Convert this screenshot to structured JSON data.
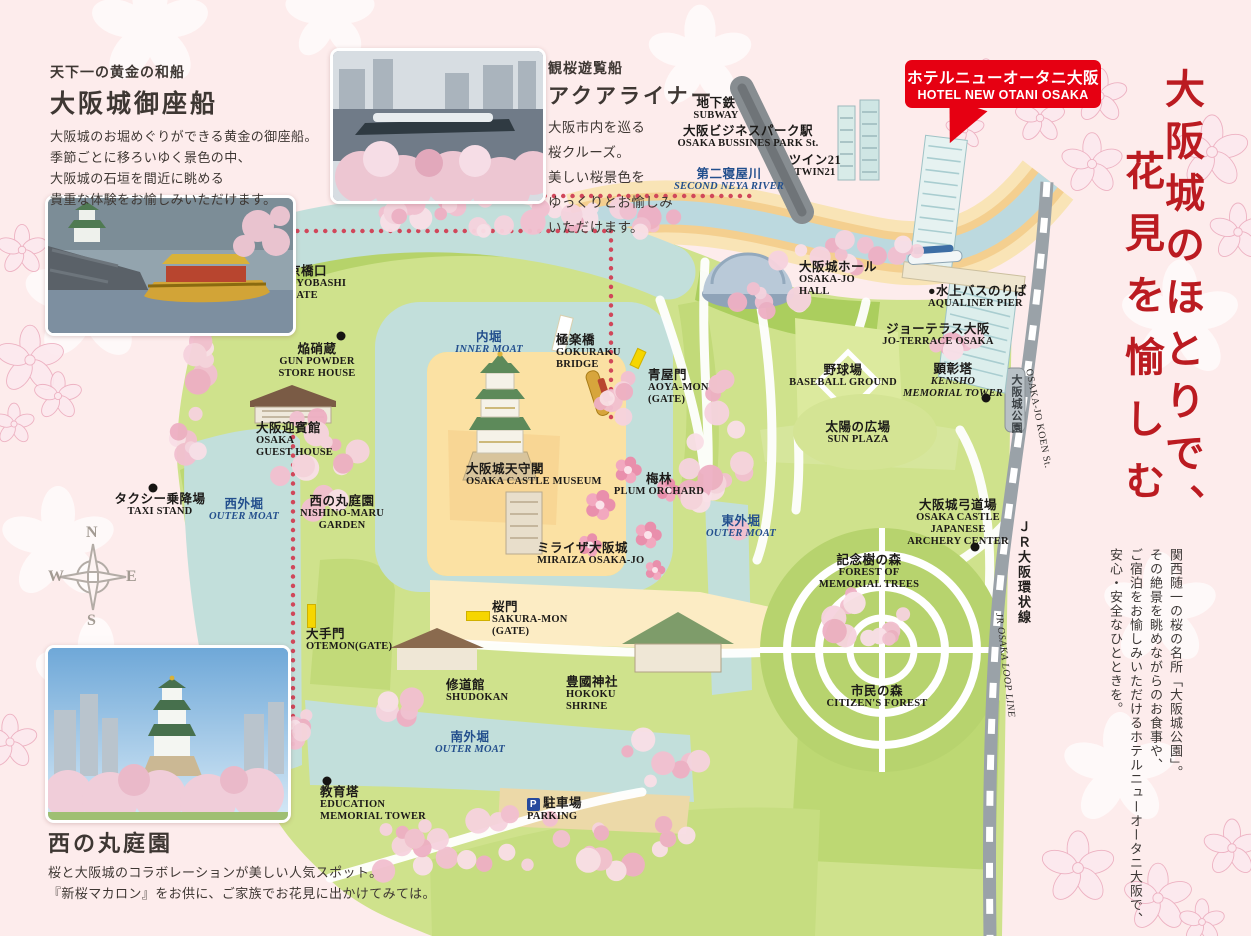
{
  "headline": {
    "line1": "大阪城のほとりで、",
    "line2": "花見を愉しむ"
  },
  "tagline": {
    "col1": "関西随一の桜の名所「大阪城公園」。",
    "col2": "その絶景を眺めながらのお食事や、",
    "col3": "ご宿泊をお愉しみいただけるホテルニューオータニ大阪で、",
    "col4": "安心・安全なひとときを。"
  },
  "hotel_badge": {
    "jp": "ホテルニューオータニ大阪",
    "en": "HOTEL NEW OTANI OSAKA",
    "bg": "#e60012"
  },
  "gozabune_info": {
    "subtitle": "天下一の黄金の和船",
    "title": "大阪城御座船",
    "body": "大阪城のお堀めぐりができる黄金の御座船。\n季節ごとに移ろいゆく景色の中、\n大阪城の石垣を間近に眺める\n貴重な体験をお愉しみいただけます。"
  },
  "aqualiner_info": {
    "subtitle": "観桜遊覧船",
    "title": "アクアライナー",
    "body": "大阪市内を巡る\n桜クルーズ。\n美しい桜景色を\nゆっくりとお愉しみ\nいただけます。"
  },
  "nishinomaru_info": {
    "title": "西の丸庭園",
    "body": "桜と大阪城のコラボレーションが美しい人気スポット。\n『新桜マカロン』をお供に、ご家族でお花見に出かけてみては。"
  },
  "compass": {
    "n": "N",
    "e": "E",
    "s": "S",
    "w": "W"
  },
  "railway": {
    "station_jp": "大阪城公園",
    "station_en": "OSAKA-JO KOEN St.",
    "line_jp": "ＪＲ大阪環状線",
    "line_en": "JR OSAKA LOOP LINE"
  },
  "icons": {
    "parking": "P"
  },
  "colors": {
    "accent_red": "#bb1b21",
    "badge_red": "#e60012",
    "moat_blue": "#c2dfdb",
    "park_green": "#cfe28c",
    "label_blue": "#234f8d",
    "dotted_red": "#d0475a"
  },
  "map_labels": [
    {
      "id": "subway",
      "jp": "地下鉄",
      "en": "SUBWAY",
      "x": 716,
      "y": 96,
      "align": "c"
    },
    {
      "id": "obp-station",
      "jp": "大阪ビジネスパーク駅",
      "en": "OSAKA BUSSINES PARK St.",
      "x": 748,
      "y": 124,
      "align": "c"
    },
    {
      "id": "twin21",
      "jp": "ツイン21",
      "en": "TWIN21",
      "x": 815,
      "y": 153,
      "align": "c"
    },
    {
      "id": "second-neya-river",
      "jp": "第二寝屋川",
      "en": "SECOND NEYA RIVER",
      "x": 729,
      "y": 167,
      "align": "c",
      "color": "b",
      "it": true
    },
    {
      "id": "osakajo-hall",
      "jp": "大阪城ホール",
      "en": "OSAKA-JO\nHALL",
      "x": 799,
      "y": 260,
      "align": "l"
    },
    {
      "id": "aqualiner-pier",
      "jp": "●水上バスのりば",
      "en": "AQUALINER PIER",
      "x": 928,
      "y": 284,
      "align": "l"
    },
    {
      "id": "jo-terrace",
      "jp": "ジョーテラス大阪",
      "en": "JO-TERRACE OSAKA",
      "x": 938,
      "y": 322,
      "align": "c"
    },
    {
      "id": "baseball-ground",
      "jp": "野球場",
      "en": "BASEBALL GROUND",
      "x": 843,
      "y": 363,
      "align": "c"
    },
    {
      "id": "kensho-tower",
      "jp": "顕彰塔",
      "en": "KENSHO\nMEMORIAL TOWER",
      "x": 953,
      "y": 362,
      "align": "c",
      "it": true
    },
    {
      "id": "sun-plaza",
      "jp": "太陽の広場",
      "en": "SUN PLAZA",
      "x": 858,
      "y": 420,
      "align": "c"
    },
    {
      "id": "archery-center",
      "jp": "大阪城弓道場",
      "en": "OSAKA CASTLE\nJAPANESE\nARCHERY CENTER",
      "x": 958,
      "y": 498,
      "align": "c"
    },
    {
      "id": "inner-moat",
      "jp": "内堀",
      "en": "INNER MOAT",
      "x": 489,
      "y": 330,
      "align": "c",
      "color": "b",
      "it": true
    },
    {
      "id": "gokuraku-bridge",
      "jp": "極楽橋",
      "en": "GOKURAKU\nBRIDGE",
      "x": 556,
      "y": 333,
      "align": "l"
    },
    {
      "id": "aoya-mon",
      "jp": "青屋門",
      "en": "AOYA-MON\n(GATE)",
      "x": 648,
      "y": 368,
      "align": "l"
    },
    {
      "id": "gunpowder-storehouse",
      "jp": "焔硝蔵",
      "en": "GUN POWDER\nSTORE HOUSE",
      "x": 317,
      "y": 342,
      "align": "c"
    },
    {
      "id": "guest-house",
      "jp": "大阪迎賓館",
      "en": "OSAKA\nGUEST HOUSE",
      "x": 256,
      "y": 421,
      "align": "l"
    },
    {
      "id": "kyobashi-gate",
      "jp": "京橋口",
      "en": "KYOBASHI\nGATE",
      "x": 288,
      "y": 264,
      "align": "l"
    },
    {
      "id": "taxi-stand",
      "jp": "タクシー乗降場",
      "en": "TAXI STAND",
      "x": 160,
      "y": 492,
      "align": "c"
    },
    {
      "id": "outer-moat-west",
      "jp": "西外堀",
      "en": "OUTER MOAT",
      "x": 244,
      "y": 497,
      "align": "c",
      "color": "b",
      "it": true
    },
    {
      "id": "nishino-maru-garden",
      "jp": "西の丸庭園",
      "en": "NISHINO-MARU\nGARDEN",
      "x": 342,
      "y": 494,
      "align": "c"
    },
    {
      "id": "castle-museum",
      "jp": "大阪城天守閣",
      "en": "OSAKA CASTLE MUSEUM",
      "x": 466,
      "y": 462,
      "align": "l"
    },
    {
      "id": "plum-orchard",
      "jp": "梅林",
      "en": "PLUM ORCHARD",
      "x": 659,
      "y": 472,
      "align": "c"
    },
    {
      "id": "miraiza",
      "jp": "ミライザ大阪城",
      "en": "MIRAIZA OSAKA-JO",
      "x": 537,
      "y": 541,
      "align": "l"
    },
    {
      "id": "outer-moat-east",
      "jp": "東外堀",
      "en": "OUTER MOAT",
      "x": 741,
      "y": 514,
      "align": "c",
      "color": "b",
      "it": true
    },
    {
      "id": "memorial-trees",
      "jp": "記念樹の森",
      "en": "FOREST OF\nMEMORIAL TREES",
      "x": 869,
      "y": 553,
      "align": "c"
    },
    {
      "id": "citizens-forest",
      "jp": "市民の森",
      "en": "CITIZEN'S FOREST",
      "x": 877,
      "y": 684,
      "align": "c"
    },
    {
      "id": "otemon-gate",
      "jp": "大手門",
      "en": "OTEMON(GATE)",
      "x": 306,
      "y": 627,
      "align": "l"
    },
    {
      "id": "sakura-mon",
      "jp": "桜門",
      "en": "SAKURA-MON\n(GATE)",
      "x": 492,
      "y": 600,
      "align": "l"
    },
    {
      "id": "shudokan",
      "jp": "修道館",
      "en": "SHUDOKAN",
      "x": 446,
      "y": 678,
      "align": "l"
    },
    {
      "id": "hokoku-shrine",
      "jp": "豊國神社",
      "en": "HOKOKU\nSHRINE",
      "x": 566,
      "y": 675,
      "align": "l"
    },
    {
      "id": "outer-moat-south",
      "jp": "南外堀",
      "en": "OUTER MOAT",
      "x": 470,
      "y": 730,
      "align": "c",
      "color": "b",
      "it": true
    },
    {
      "id": "education-tower",
      "jp": "教育塔",
      "en": "EDUCATION\nMEMORIAL TOWER",
      "x": 320,
      "y": 785,
      "align": "l"
    },
    {
      "id": "parking",
      "jp": "駐車場",
      "en": "PARKING",
      "x": 527,
      "y": 796,
      "align": "l",
      "picon": true
    }
  ]
}
